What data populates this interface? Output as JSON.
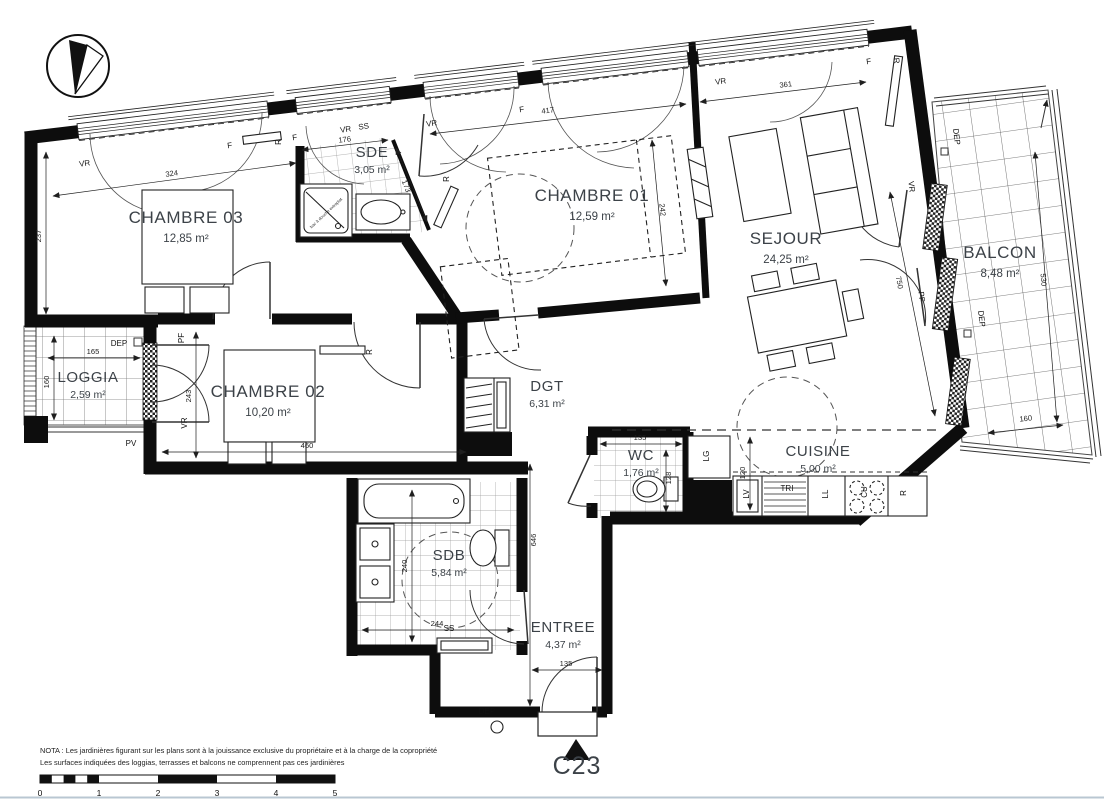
{
  "colors": {
    "wall": "#0d0d0d",
    "label": "#3c4248",
    "dim": "#1f1f1f",
    "grid": "#999999",
    "page_rule": "#b9c7d2"
  },
  "unit": {
    "label": "C23"
  },
  "notes": {
    "line1": "NOTA : Les jardinières figurant sur les plans sont à la jouissance exclusive du propriétaire et à la charge de la copropriété",
    "line2": "Les surfaces indiquées des loggias, terrasses et balcons ne comprennent pas ces jardinières"
  },
  "scale_bar": {
    "ticks": [
      {
        "t": "0",
        "x": 40
      },
      {
        "t": "1",
        "x": 99
      },
      {
        "t": "2",
        "x": 158
      },
      {
        "t": "3",
        "x": 217
      },
      {
        "t": "4",
        "x": 276
      },
      {
        "t": "5",
        "x": 335
      }
    ]
  },
  "rooms": [
    {
      "id": "chambre03",
      "name": "CHAMBRE 03",
      "area": "12,85 m²",
      "x": 186,
      "y": 223,
      "size": 17
    },
    {
      "id": "sde",
      "name": "SDE",
      "area": "3,05 m²",
      "x": 372,
      "y": 157,
      "size": 15
    },
    {
      "id": "chambre01",
      "name": "CHAMBRE 01",
      "area": "12,59 m²",
      "x": 592,
      "y": 201,
      "size": 17
    },
    {
      "id": "sejour",
      "name": "SEJOUR",
      "area": "24,25 m²",
      "x": 786,
      "y": 244,
      "size": 17
    },
    {
      "id": "balcon",
      "name": "BALCON",
      "area": "8,48 m²",
      "x": 1000,
      "y": 258,
      "size": 17
    },
    {
      "id": "loggia",
      "name": "LOGGIA",
      "area": "2,59 m²",
      "x": 88,
      "y": 382,
      "size": 15
    },
    {
      "id": "chambre02",
      "name": "CHAMBRE 02",
      "area": "10,20 m²",
      "x": 268,
      "y": 397,
      "size": 17
    },
    {
      "id": "dgt",
      "name": "DGT",
      "area": "6,31 m²",
      "x": 547,
      "y": 391,
      "size": 15
    },
    {
      "id": "wc",
      "name": "WC",
      "area": "1,76 m²",
      "x": 641,
      "y": 460,
      "size": 15
    },
    {
      "id": "cuisine",
      "name": "CUISINE",
      "area": "5,00 m²",
      "x": 818,
      "y": 456,
      "size": 15
    },
    {
      "id": "sdb",
      "name": "SDB",
      "area": "5,84 m²",
      "x": 449,
      "y": 560,
      "size": 15
    },
    {
      "id": "entree",
      "name": "ENTREE",
      "area": "4,37 m²",
      "x": 563,
      "y": 632,
      "size": 15
    }
  ],
  "dimensions": [
    {
      "v": "324",
      "x1": 53,
      "y1": 196,
      "x2": 296,
      "y2": 163,
      "lx": 172,
      "ly": 176,
      "rot": -8
    },
    {
      "v": "237",
      "x1": 46,
      "y1": 152,
      "x2": 46,
      "y2": 314,
      "lx": 41,
      "ly": 236,
      "rot": -90
    },
    {
      "v": "176",
      "x1": 302,
      "y1": 150,
      "x2": 388,
      "y2": 140,
      "lx": 345,
      "ly": 142,
      "rot": -7
    },
    {
      "v": "173",
      "x1": 396,
      "y1": 148,
      "x2": 427,
      "y2": 222,
      "lx": 404,
      "ly": 187,
      "rot": 68
    },
    {
      "v": "417",
      "x1": 430,
      "y1": 134,
      "x2": 686,
      "y2": 104,
      "lx": 548,
      "ly": 113,
      "rot": -7
    },
    {
      "v": "361",
      "x1": 700,
      "y1": 102,
      "x2": 866,
      "y2": 82,
      "lx": 786,
      "ly": 87,
      "rot": -7
    },
    {
      "v": "242",
      "x1": 652,
      "y1": 140,
      "x2": 666,
      "y2": 286,
      "lx": 660,
      "ly": 210,
      "rot": 84
    },
    {
      "v": "750",
      "x1": 890,
      "y1": 192,
      "x2": 935,
      "y2": 416,
      "lx": 897,
      "ly": 283,
      "rot": 79
    },
    {
      "v": "530",
      "x1": 1035,
      "y1": 152,
      "x2": 1057,
      "y2": 422,
      "lx": 1041,
      "ly": 280,
      "rot": 85
    },
    {
      "v": "160",
      "x1": 988,
      "y1": 433,
      "x2": 1063,
      "y2": 425,
      "lx": 1026,
      "ly": 421,
      "rot": -6
    },
    {
      "v": "165",
      "x1": 48,
      "y1": 358,
      "x2": 140,
      "y2": 358,
      "lx": 93,
      "ly": 354,
      "rot": 0
    },
    {
      "v": "160",
      "x1": 54,
      "y1": 336,
      "x2": 54,
      "y2": 420,
      "lx": 49,
      "ly": 382,
      "rot": -90
    },
    {
      "v": "243",
      "x1": 196,
      "y1": 332,
      "x2": 196,
      "y2": 458,
      "lx": 191,
      "ly": 396,
      "rot": -90
    },
    {
      "v": "460",
      "x1": 162,
      "y1": 452,
      "x2": 466,
      "y2": 452,
      "lx": 307,
      "ly": 448,
      "rot": 0
    },
    {
      "v": "244",
      "x1": 362,
      "y1": 630,
      "x2": 514,
      "y2": 630,
      "lx": 437,
      "ly": 626,
      "rot": 0
    },
    {
      "v": "240",
      "x1": 412,
      "y1": 490,
      "x2": 412,
      "y2": 642,
      "lx": 407,
      "ly": 566,
      "rot": -90
    },
    {
      "v": "646",
      "x1": 530,
      "y1": 464,
      "x2": 530,
      "y2": 706,
      "lx": 536,
      "ly": 540,
      "rot": -90
    },
    {
      "v": "135",
      "x1": 600,
      "y1": 444,
      "x2": 682,
      "y2": 444,
      "lx": 640,
      "ly": 440,
      "rot": 0
    },
    {
      "v": "128",
      "x1": 666,
      "y1": 450,
      "x2": 666,
      "y2": 512,
      "lx": 671,
      "ly": 478,
      "rot": -90
    },
    {
      "v": "120",
      "x1": 750,
      "y1": 437,
      "x2": 750,
      "y2": 510,
      "lx": 745,
      "ly": 473,
      "rot": -90
    },
    {
      "v": "135",
      "x1": 532,
      "y1": 670,
      "x2": 602,
      "y2": 670,
      "lx": 566,
      "ly": 666,
      "rot": 0
    }
  ],
  "wall_labels": [
    {
      "t": "VR",
      "x": 85,
      "y": 166,
      "r": -8
    },
    {
      "t": "F",
      "x": 230,
      "y": 148,
      "r": -8
    },
    {
      "t": "R",
      "x": 281,
      "y": 142,
      "r": -90
    },
    {
      "t": "F",
      "x": 295,
      "y": 140,
      "r": -8
    },
    {
      "t": "VR",
      "x": 346,
      "y": 132,
      "r": -8
    },
    {
      "t": "SS",
      "x": 364,
      "y": 129,
      "r": -8
    },
    {
      "t": "VR",
      "x": 432,
      "y": 126,
      "r": -8
    },
    {
      "t": "F",
      "x": 522,
      "y": 112,
      "r": -8
    },
    {
      "t": "VR",
      "x": 721,
      "y": 84,
      "r": -8
    },
    {
      "t": "F",
      "x": 869,
      "y": 64,
      "r": -8
    },
    {
      "t": "R",
      "x": 894,
      "y": 61,
      "r": 83
    },
    {
      "t": "VR",
      "x": 909,
      "y": 187,
      "r": 83
    },
    {
      "t": "PF",
      "x": 919,
      "y": 297,
      "r": 83
    },
    {
      "t": "DEP",
      "x": 954,
      "y": 137,
      "r": 83
    },
    {
      "t": "DEP",
      "x": 979,
      "y": 319,
      "r": 83
    },
    {
      "t": "R",
      "x": 449,
      "y": 179,
      "r": -90
    },
    {
      "t": "PF",
      "x": 184,
      "y": 338,
      "r": -90
    },
    {
      "t": "VR",
      "x": 187,
      "y": 423,
      "r": -90
    },
    {
      "t": "DEP",
      "x": 119,
      "y": 346,
      "r": 0
    },
    {
      "t": "PV",
      "x": 131,
      "y": 446,
      "r": 0
    },
    {
      "t": "R",
      "x": 372,
      "y": 352,
      "r": -90
    },
    {
      "t": "SS",
      "x": 449,
      "y": 631,
      "r": 0
    },
    {
      "t": "DEP",
      "x": 487,
      "y": 714,
      "r": 0
    },
    {
      "t": "LG",
      "x": 709,
      "y": 456,
      "r": -90
    },
    {
      "t": "LV",
      "x": 749,
      "y": 494,
      "r": -90
    },
    {
      "t": "TRI",
      "x": 787,
      "y": 491,
      "r": 0
    },
    {
      "t": "LL",
      "x": 828,
      "y": 494,
      "r": -90
    },
    {
      "t": "CU",
      "x": 867,
      "y": 492,
      "r": -90
    },
    {
      "t": "R",
      "x": 906,
      "y": 493,
      "r": -90
    }
  ],
  "fixture_note": {
    "text": "bac à douche extraplat",
    "x": 327,
    "y": 214,
    "rot": -43
  }
}
